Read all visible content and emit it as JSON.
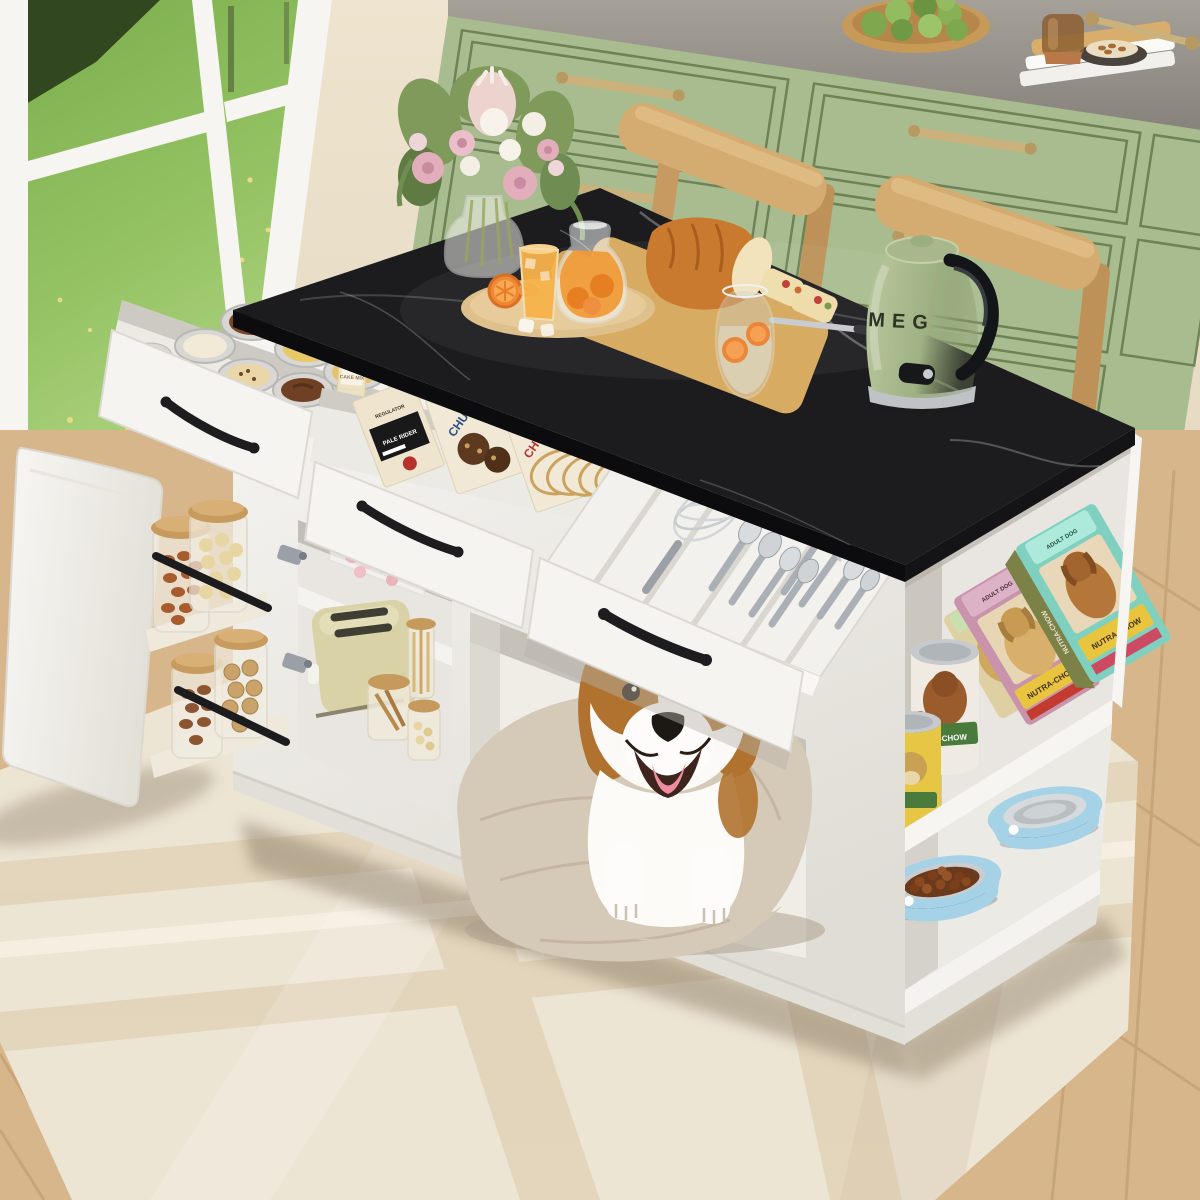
{
  "scene": {
    "type": "product-photo",
    "subject": "White kitchen island pet station with black marble top, open drawers, pantry storage and a beagle in the built-in dog bed nook",
    "labels": {
      "kettle_brand": "MEG",
      "bag_brand": "NUTRA-CHOW",
      "bag_flavor_tag": "ADULT DOG",
      "can_brand_visible": "TRA-CHOW",
      "cracker_box_brand": "REGULATOR",
      "cracker_box_name": "PALE RIDER",
      "cookie_box_blue": "CHUNKS",
      "cookie_box_red": "CHUNKS",
      "pantry_jar": "CAKE MIX"
    },
    "colors": {
      "marble": "#1c1c1f",
      "island_white": "#f4f2ef",
      "cabinet_sage": "#a9bc8f",
      "counter_gray": "#99958d",
      "chair_wood": "#d4ab70",
      "rug_beige": "#ede5d4",
      "floor_wood": "#d7b68c",
      "kettle_green": "#a3b482",
      "bowl_blue": "#a5d2e6",
      "bag_pink": "#c893ab",
      "bag_teal": "#7fd0bf",
      "brand_yellow": "#e9c53f",
      "can_green_band": "#4a7a3c",
      "box_blue": "#2d4f86",
      "box_red": "#b23530",
      "dog_brown": "#b0722e",
      "cushion_beige": "#d5c9b7",
      "tongue_pink": "#ee8da0",
      "grass_green": "#8fbe5d",
      "brass": "#cbb27c"
    }
  }
}
